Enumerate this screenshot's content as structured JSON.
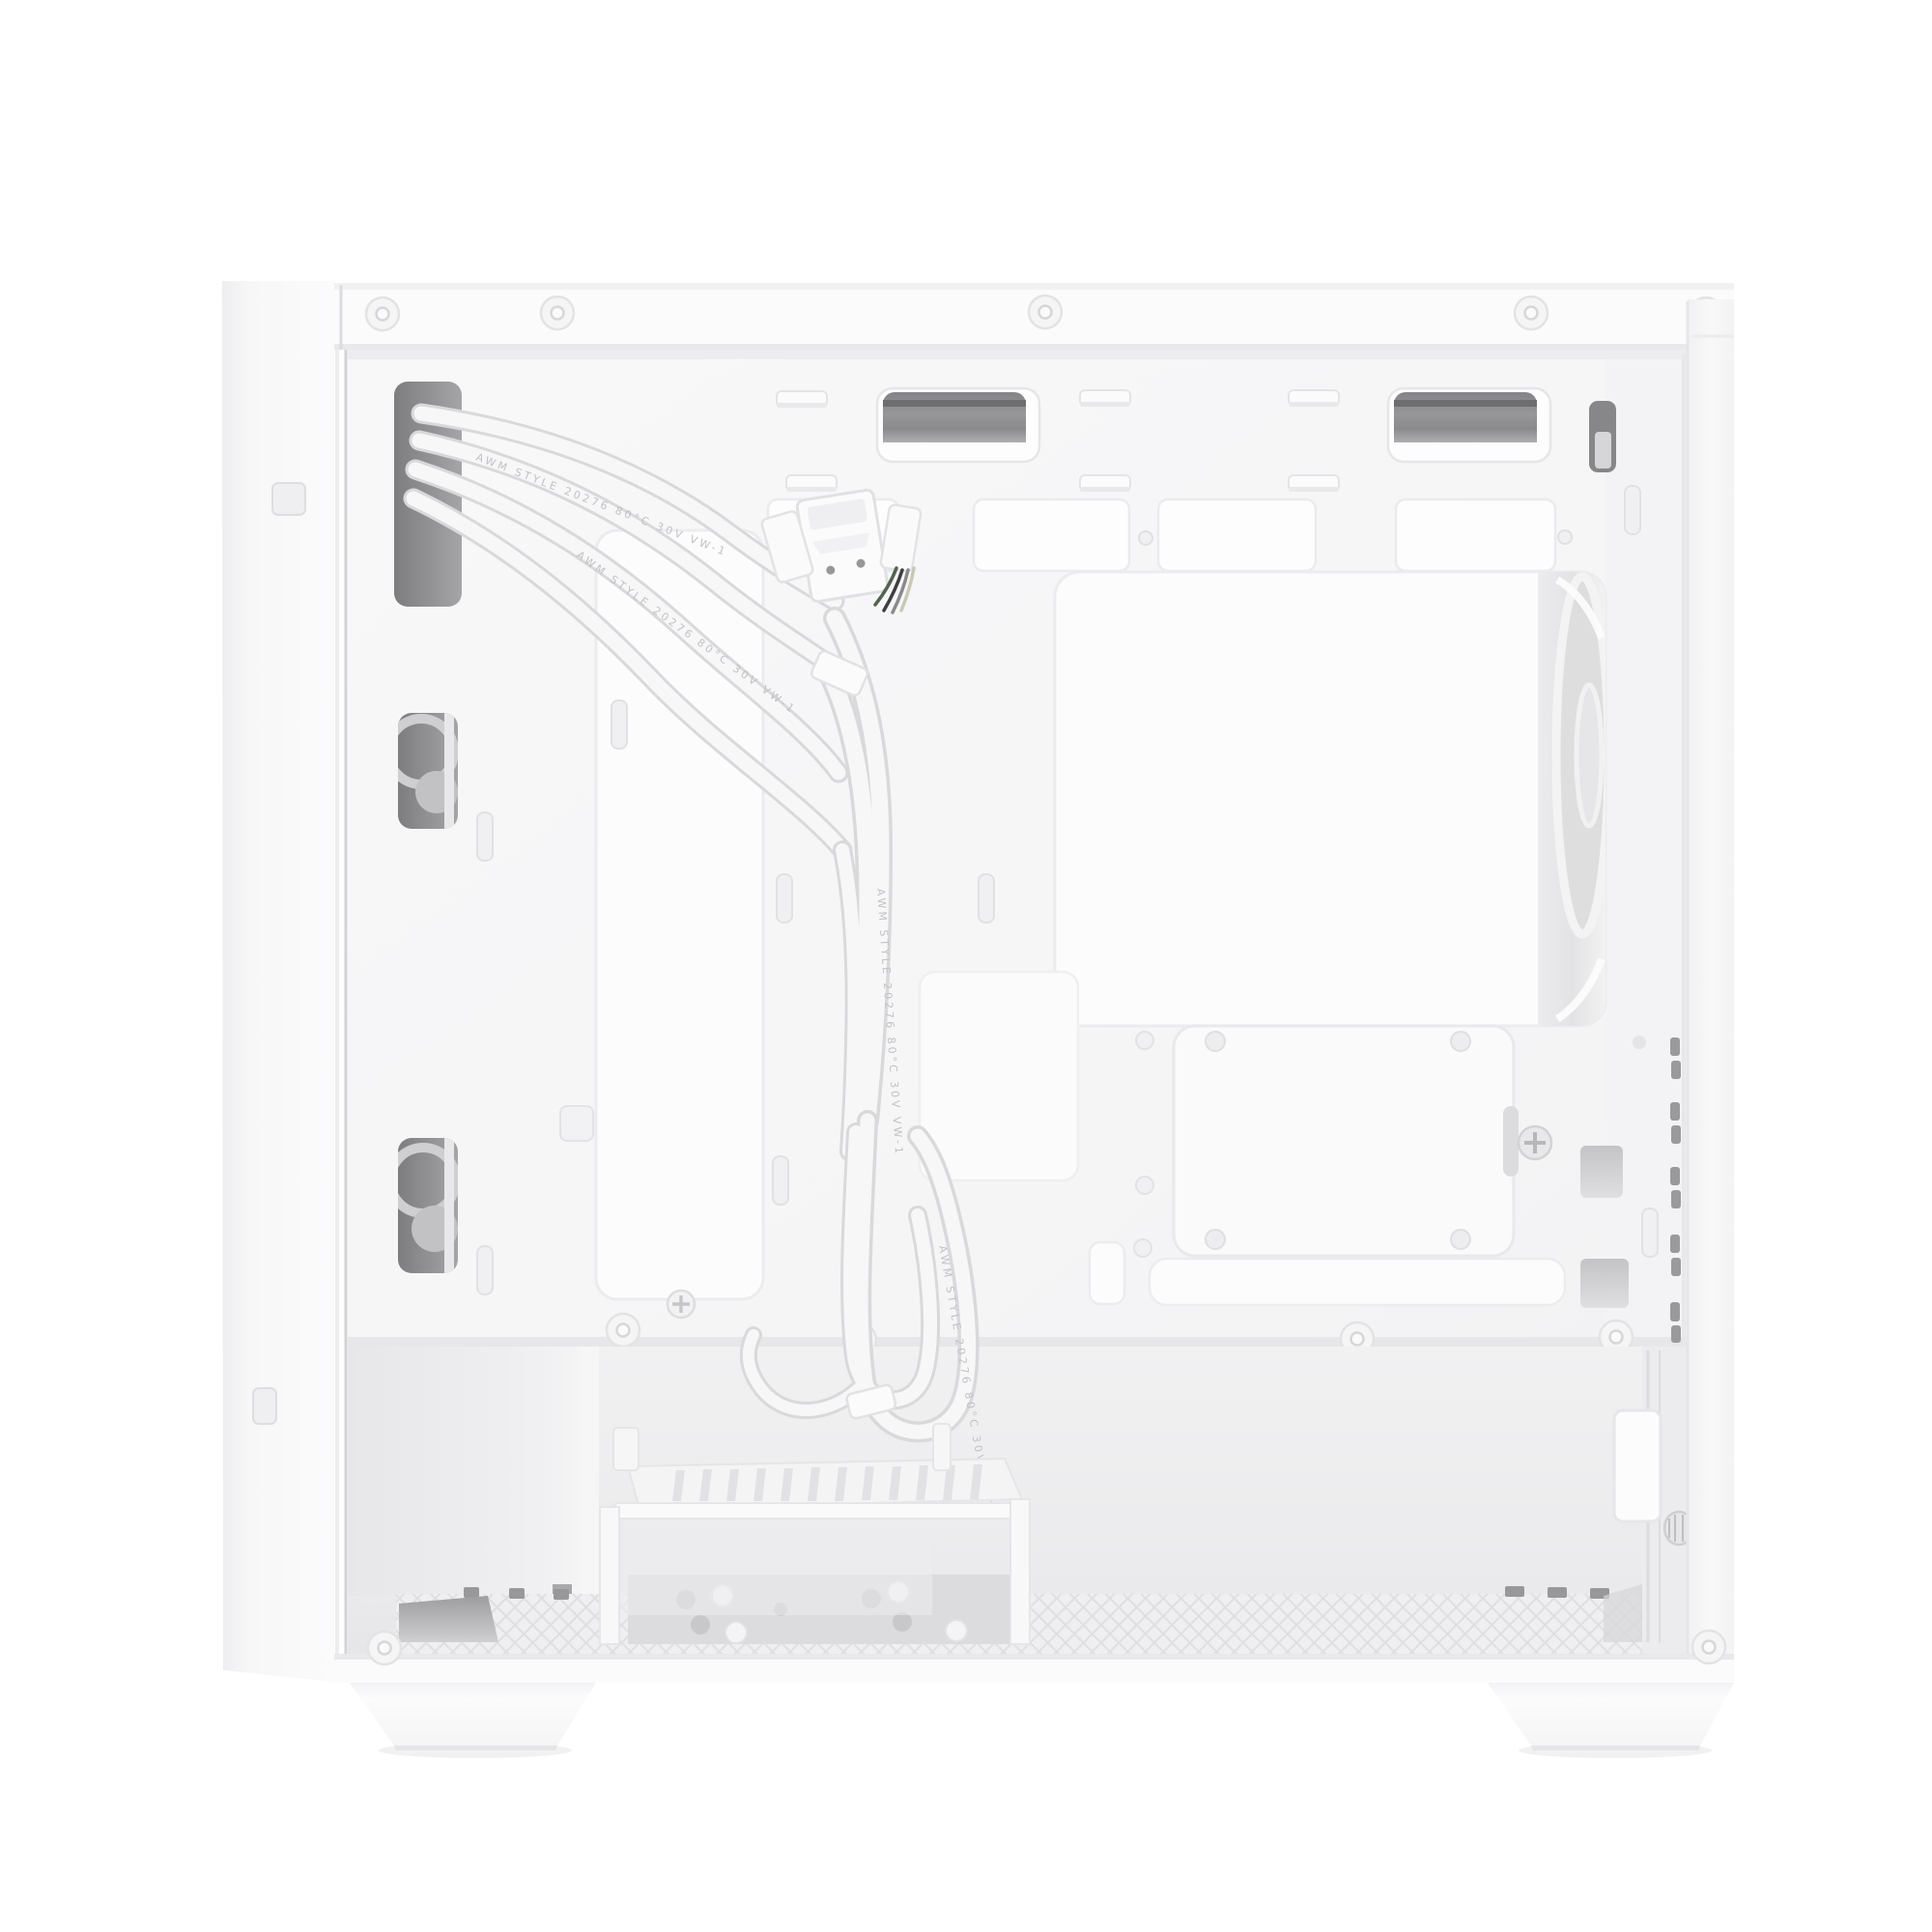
{
  "image": {
    "subject": "White mini-tower PC case, cable-management side with panel removed",
    "background": "#ffffff"
  },
  "palette": {
    "case_white": "#fafafb",
    "tray_white": "#f6f6f7",
    "recess_white": "#fdfdfe",
    "seam": "#e6e6e9",
    "interior": "#efeff1",
    "mesh": "#ececee",
    "mesh_line": "#d8d8da",
    "metal_gray": "#c9c9cc",
    "dark_cutout": "#77777a",
    "cable_white": "#f7f7f8",
    "cable_edge": "#d9d9dc"
  },
  "cable_marking": "AWM STYLE 20276 80°C 30V VW-1"
}
